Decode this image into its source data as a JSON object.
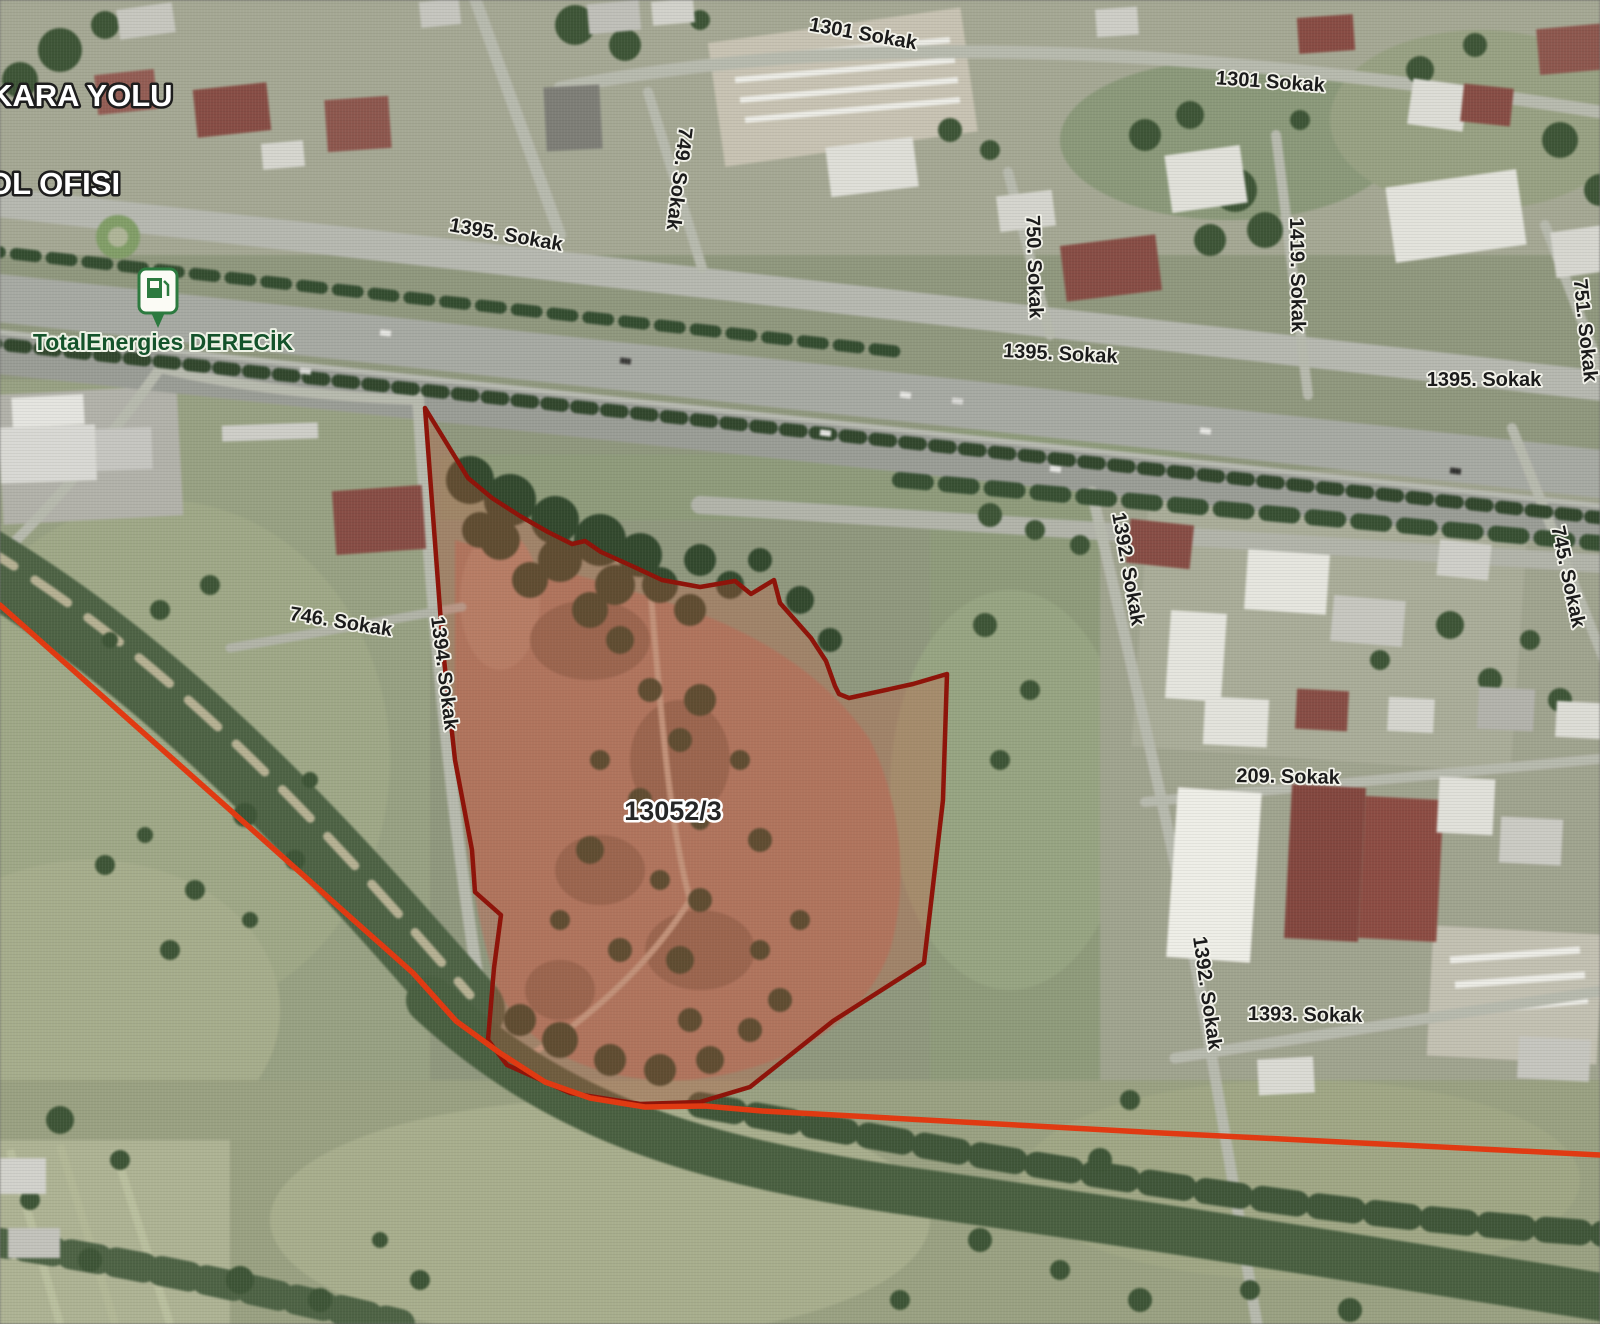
{
  "corner_labels": {
    "line1": "KARA YOLU",
    "line2": "OL OFISI"
  },
  "poi": {
    "name": "TotalEnergies DERECİK"
  },
  "parcel": {
    "number": "13052/3"
  },
  "streets": [
    "1301 Sokak",
    "1301 Sokak",
    "749. Sokak",
    "1395. Sokak",
    "750. Sokak",
    "1419. Sokak",
    "751. Sokak",
    "1395. Sokak",
    "1395. Sokak",
    "1392. Sokak",
    "746. Sokak",
    "1394. Sokak",
    "745. Sokak",
    "209. Sokak",
    "1392. Sokak",
    "1393. Sokak"
  ],
  "colors": {
    "parcel_stroke": "#8E140A",
    "parcel_fill": "rgba(200,86,58,0.30)",
    "red_line": "#E03A12",
    "poi_text": "#14532B",
    "street_text": "#1B1B1B",
    "parcel_text": "#262626",
    "corner_text": "#FFFFFF",
    "marker_green": "#2C7A3F"
  }
}
